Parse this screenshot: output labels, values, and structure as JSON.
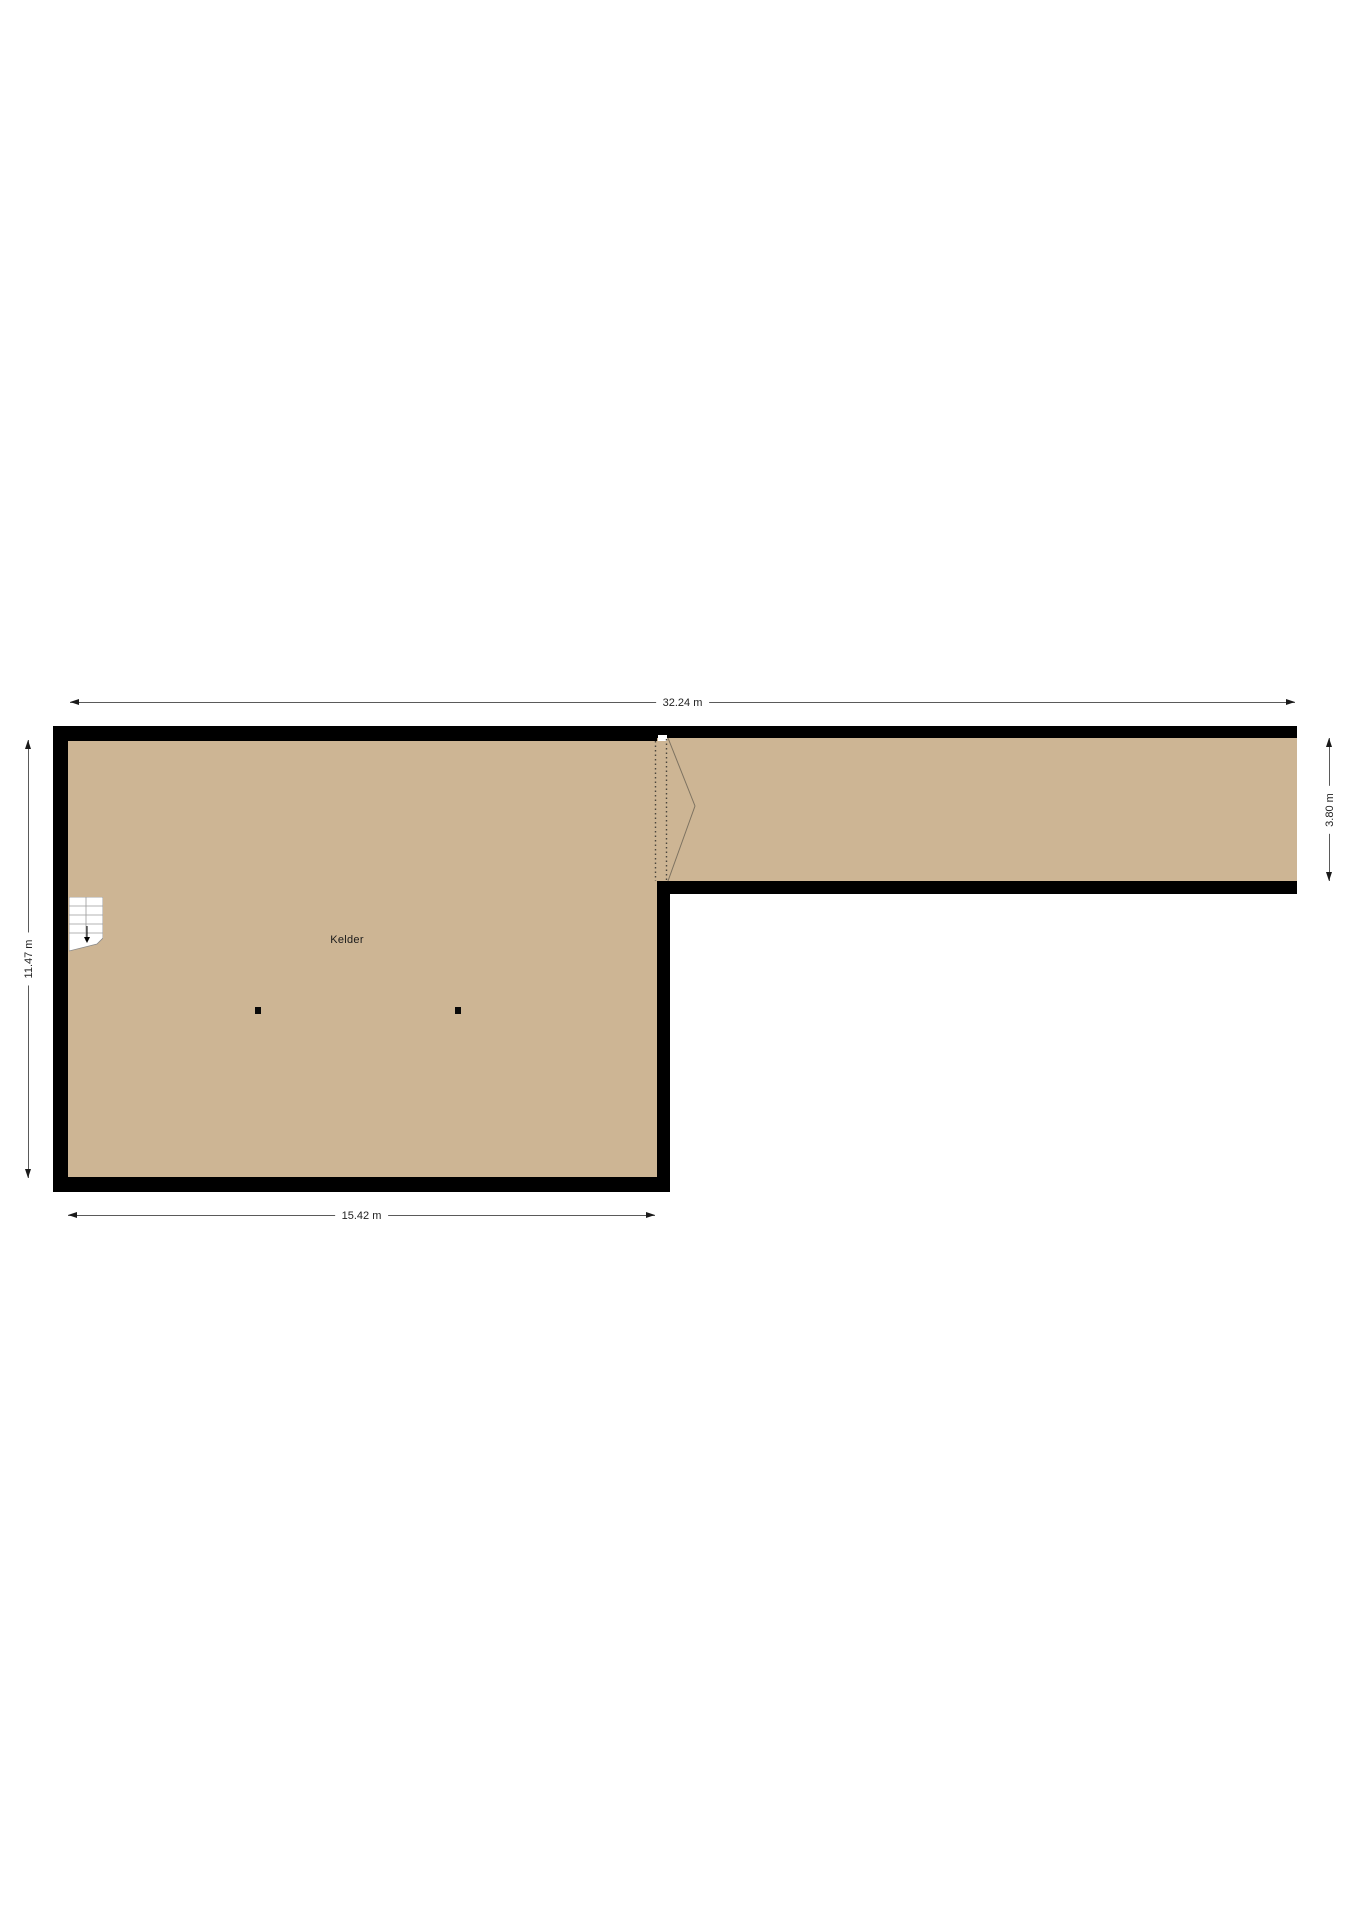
{
  "floorplan": {
    "room": {
      "label": "Kelder"
    },
    "dimensions": {
      "overall_width": "32.24 m",
      "main_room_width": "15.42 m",
      "main_room_depth": "11.47 m",
      "corridor_depth": "3.80 m"
    },
    "colors": {
      "floor_fill": "#cdb594",
      "wall": "#000000",
      "dimension_line": "#5a5a5a"
    },
    "features": {
      "stairs": "stairs-down-arrow",
      "column_count": 2
    }
  }
}
